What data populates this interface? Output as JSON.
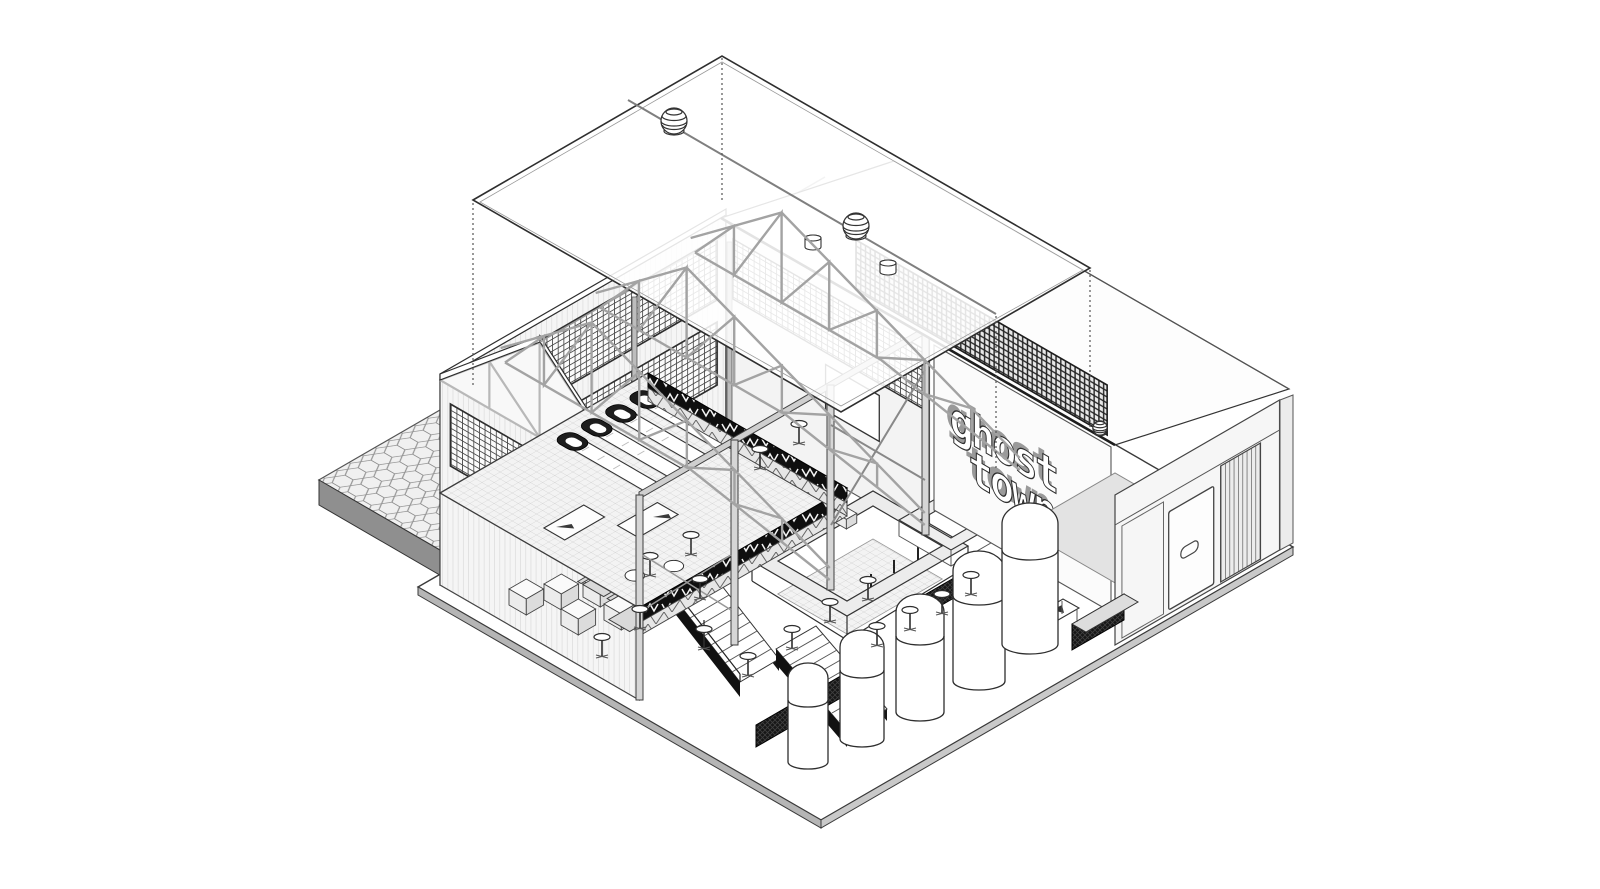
{
  "drawing": {
    "type": "axonometric-cutaway-architectural-drawing",
    "style": "black and white line drawing of a two-storey taproom hall with mezzanine, bar and tank room",
    "signage": {
      "line1": "ghost",
      "line2": "town"
    }
  },
  "palette": {
    "background": "#ffffff",
    "line_dark": "#2e2e2e",
    "line_mid": "#555555",
    "line_light": "#a3a3a3",
    "fill_light": "#f2f2f2",
    "fill_mid": "#d9d9d9",
    "fill_black": "#111111"
  },
  "inventory": {
    "fermentation_tanks": 5,
    "roof_turbine_vents": 2,
    "small_roof_vents": 3,
    "steel_roof_trusses": 3,
    "skeeball_lanes": 4,
    "stair_flights": 2,
    "window_bands": 2,
    "structural_columns": 4,
    "picnic_tables": 4,
    "storage_crates": 5,
    "bar_stools": 12,
    "doors": 2
  }
}
